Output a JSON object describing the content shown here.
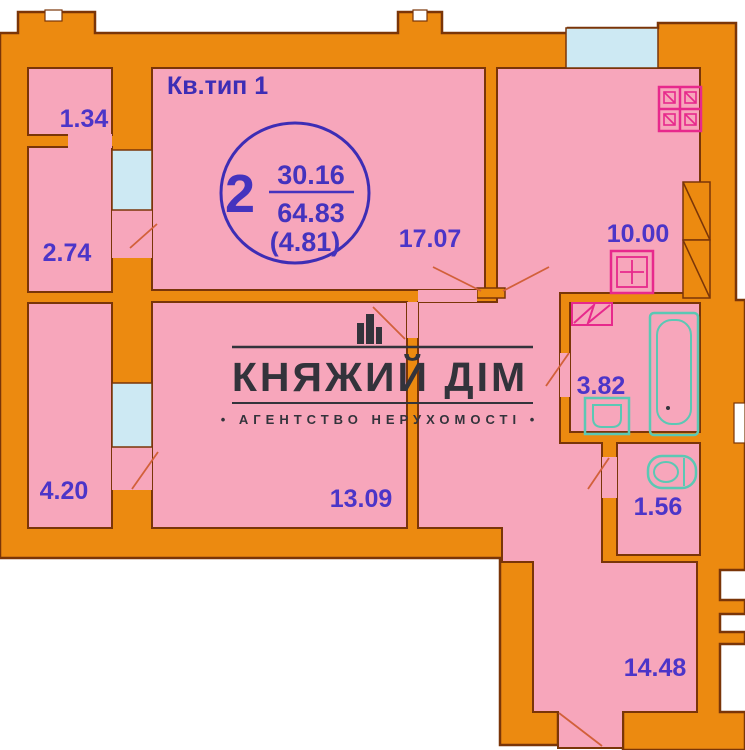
{
  "title": "Кв.тип 1",
  "apartment": {
    "room_count": "2",
    "living_area": "30.16",
    "total_area": "64.83",
    "extra_area": "(4.81)"
  },
  "rooms": [
    {
      "id": "loggia-upper",
      "label": "1.34"
    },
    {
      "id": "loggia-middle",
      "label": "2.74"
    },
    {
      "id": "loggia-lower",
      "label": "4.20"
    },
    {
      "id": "living-room",
      "label": "17.07"
    },
    {
      "id": "bedroom",
      "label": "13.09"
    },
    {
      "id": "kitchen",
      "label": "10.00"
    },
    {
      "id": "bathroom",
      "label": "3.82"
    },
    {
      "id": "wc",
      "label": "1.56"
    },
    {
      "id": "hallway",
      "label": "14.48"
    }
  ],
  "watermark": {
    "name": "КНЯЖИЙ ДІМ",
    "tagline": "• АГЕНТСТВО НЕРУХОМОСТІ •"
  },
  "icons": {
    "stove-icon": "4-burner cooktop, magenta outline",
    "kitchen-sink-icon": "sink with tap, magenta outline",
    "washing-machine-icon": "zigzag rectangle, magenta outline",
    "bathtub-icon": "bathtub, teal outline",
    "washbasin-icon": "washbasin, teal outline",
    "toilet-icon": "toilet, teal outline",
    "vent-shaft-icon": "hatched duct block",
    "logo-building-icon": "city buildings silhouette"
  },
  "colors": {
    "wall": "#EC8A10",
    "wall_outline": "#7A3508",
    "room_fill": "#F7A6BB",
    "window_fill": "#CDE9F3",
    "label": "#4C35C8",
    "oval": "#3D2DB5",
    "fixture_magenta": "#E7298C",
    "fixture_teal": "#5BC8B4",
    "door_swing": "#D2603A",
    "watermark": "#33333B"
  }
}
